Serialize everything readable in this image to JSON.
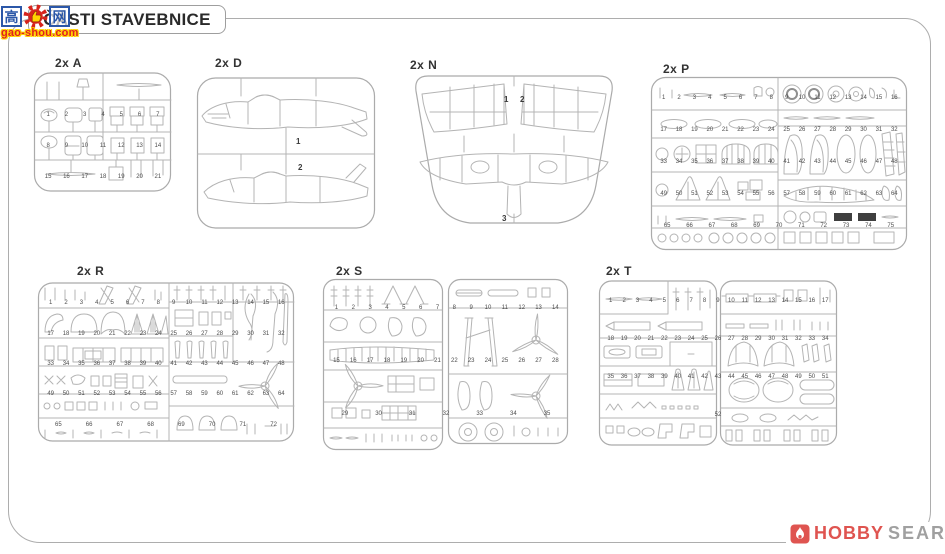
{
  "page": {
    "title": "ČÁSTI STAVEBNICE",
    "line_color": "#b4b4b4",
    "border_color": "#adadad"
  },
  "watermarks": {
    "gaoshou": {
      "char_left": "高",
      "char_right": "网",
      "domain": "gao-shou.com",
      "blue": "#2b57a8",
      "red": "#d6231c",
      "yellow": "#ffd200"
    },
    "hobbysearch": {
      "word1": "HOBBY",
      "word2": "SEARCH",
      "red": "#df5450",
      "gray": "#a0a0a0"
    }
  },
  "sprues": [
    {
      "id": "A",
      "label": "2x A",
      "part_numbers": [
        1,
        2,
        3,
        4,
        5,
        6,
        7,
        8,
        9,
        10,
        11,
        12,
        13,
        14,
        15,
        16,
        17,
        18,
        19,
        20,
        21
      ]
    },
    {
      "id": "D",
      "label": "2x D",
      "part_numbers": [
        1,
        2
      ]
    },
    {
      "id": "N",
      "label": "2x N",
      "part_numbers": [
        1,
        2,
        3
      ]
    },
    {
      "id": "P",
      "label": "2x P",
      "part_numbers": [
        1,
        2,
        3,
        4,
        5,
        6,
        7,
        8,
        9,
        10,
        11,
        12,
        13,
        14,
        15,
        16,
        17,
        18,
        19,
        20,
        21,
        22,
        23,
        24,
        25,
        26,
        27,
        28,
        29,
        30,
        31,
        32,
        33,
        34,
        35,
        36,
        37,
        38,
        39,
        40,
        41,
        42,
        43,
        44,
        45,
        46,
        47,
        48,
        49,
        50,
        51,
        52,
        53,
        54,
        55,
        56,
        57,
        58,
        59,
        60,
        61,
        62,
        63,
        64,
        65,
        66,
        67,
        68,
        69,
        70,
        71,
        72,
        73,
        74,
        75
      ]
    },
    {
      "id": "R",
      "label": "2x R",
      "part_numbers": [
        1,
        2,
        3,
        4,
        5,
        6,
        7,
        8,
        9,
        10,
        11,
        12,
        13,
        14,
        15,
        16,
        17,
        18,
        19,
        20,
        21,
        22,
        23,
        24,
        25,
        26,
        27,
        28,
        29,
        30,
        31,
        32,
        33,
        34,
        35,
        36,
        37,
        38,
        39,
        40,
        41,
        42,
        43,
        44,
        45,
        46,
        47,
        48,
        49,
        50,
        51,
        52,
        53,
        54,
        55,
        56,
        57,
        58,
        59,
        60,
        61,
        62,
        63,
        64,
        65,
        66,
        67,
        68,
        69,
        70,
        71,
        72
      ]
    },
    {
      "id": "S",
      "label": "2x S",
      "part_numbers": [
        1,
        2,
        3,
        4,
        5,
        6,
        7,
        8,
        9,
        10,
        11,
        12,
        13,
        14,
        15,
        16,
        17,
        18,
        19,
        20,
        21,
        22,
        23,
        24,
        25,
        26,
        27,
        28,
        29,
        30,
        31,
        32,
        33,
        34,
        35
      ]
    },
    {
      "id": "T",
      "label": "2x T",
      "part_numbers": [
        1,
        2,
        3,
        4,
        5,
        6,
        7,
        8,
        9,
        10,
        11,
        12,
        13,
        14,
        15,
        16,
        17,
        18,
        19,
        20,
        21,
        22,
        23,
        24,
        25,
        26,
        27,
        28,
        29,
        30,
        31,
        32,
        33,
        34,
        35,
        36,
        37,
        38,
        39,
        40,
        41,
        42,
        43,
        44,
        45,
        46,
        47,
        48,
        49,
        50,
        51,
        52
      ]
    }
  ]
}
